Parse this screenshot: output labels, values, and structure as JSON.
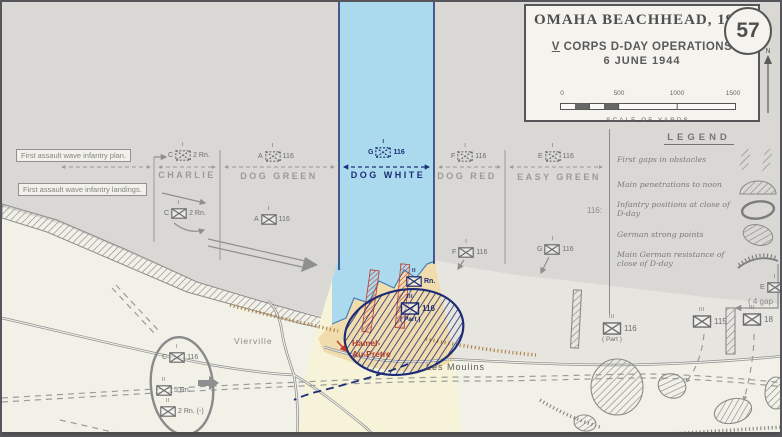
{
  "colors": {
    "sea": "#d9d8d4",
    "land": "#f2f1e8",
    "tidal_flat": "#e6e5e0",
    "band_sea": "#abdaee",
    "band_beach": "#f1dcae",
    "band_land": "#f7f3d8",
    "us_navy": "#1d2d76",
    "german_grey": "#8a8a8a",
    "red": "#c0392b",
    "road_grey": "#8f8f8f",
    "seawall_orange": "#b08648"
  },
  "title_box": {
    "title": "OMAHA BEACHHEAD, 1944",
    "map_number": "57",
    "corps_numeral": "V",
    "subtitle": "CORPS D-DAY OPERATIONS",
    "date_line": "6 JUNE 1944",
    "scale": {
      "ticks": [
        "0",
        "500",
        "1000",
        "1500"
      ],
      "caption": "SCALE OF YARDS"
    },
    "north_label": "N"
  },
  "legend": {
    "title": "LEGEND",
    "items": [
      {
        "label": "First gaps in obstacles",
        "symbol": "gap-in-obstacles"
      },
      {
        "label": "Main penetrations to noon",
        "symbol": "penetration-fan"
      },
      {
        "label": "Infantry positions at close of D-day",
        "symbol": "infantry-position-oval"
      },
      {
        "label": "German strong points",
        "symbol": "strongpoint-hatch"
      },
      {
        "label": "Main German resistance of close of D-day",
        "symbol": "resistance-arc"
      }
    ]
  },
  "callouts": {
    "plan_label": "First assault wave infantry plan.",
    "landings_label": "First assault wave infantry landings."
  },
  "sectors": [
    "CHARLIE",
    "DOG GREEN",
    "DOG WHITE",
    "DOG RED",
    "EASY GREEN"
  ],
  "units": [
    {
      "prefix": "C",
      "label": "2 Rn.",
      "size": "I",
      "note": ""
    },
    {
      "prefix": "A",
      "label": "116",
      "size": "I",
      "note": ""
    },
    {
      "prefix": "G",
      "label": "116",
      "size": "I",
      "note": ""
    },
    {
      "prefix": "F",
      "label": "116",
      "size": "I",
      "note": ""
    },
    {
      "prefix": "E",
      "label": "116",
      "size": "I",
      "note": ""
    },
    {
      "prefix": "C",
      "label": "2 Rn.",
      "size": "I",
      "note": ""
    },
    {
      "prefix": "A",
      "label": "116",
      "size": "I",
      "note": ""
    },
    {
      "prefix": "F",
      "label": "116",
      "size": "I",
      "note": ""
    },
    {
      "prefix": "G",
      "label": "116",
      "size": "I",
      "note": ""
    },
    {
      "prefix": "",
      "label": "Rn.",
      "size": "II",
      "note": ""
    },
    {
      "prefix": "",
      "label": "116",
      "size": "III",
      "note": "( Part )"
    },
    {
      "prefix": "",
      "label": "116",
      "size": "III",
      "note": "( Part )"
    },
    {
      "prefix": "",
      "label": "115",
      "size": "III",
      "note": ""
    },
    {
      "prefix": "",
      "label": "18",
      "size": "III",
      "note": ""
    },
    {
      "prefix": "E",
      "label": "",
      "size": "I",
      "note": ""
    },
    {
      "prefix": "C",
      "label": "116",
      "size": "I",
      "note": ""
    },
    {
      "prefix": "",
      "label": "5 Rn.",
      "size": "II",
      "note": ""
    },
    {
      "prefix": "",
      "label": "2 Rn. (-)",
      "size": "II",
      "note": ""
    }
  ],
  "places": {
    "vierville": "Vierville",
    "hamel_line1": "Hamel-",
    "hamel_line2": "Au-Pretre",
    "les_moulins": "Les Moulins"
  },
  "annotations": {
    "regiment_marker": "116:",
    "gaps_note": "( 4 gap"
  }
}
